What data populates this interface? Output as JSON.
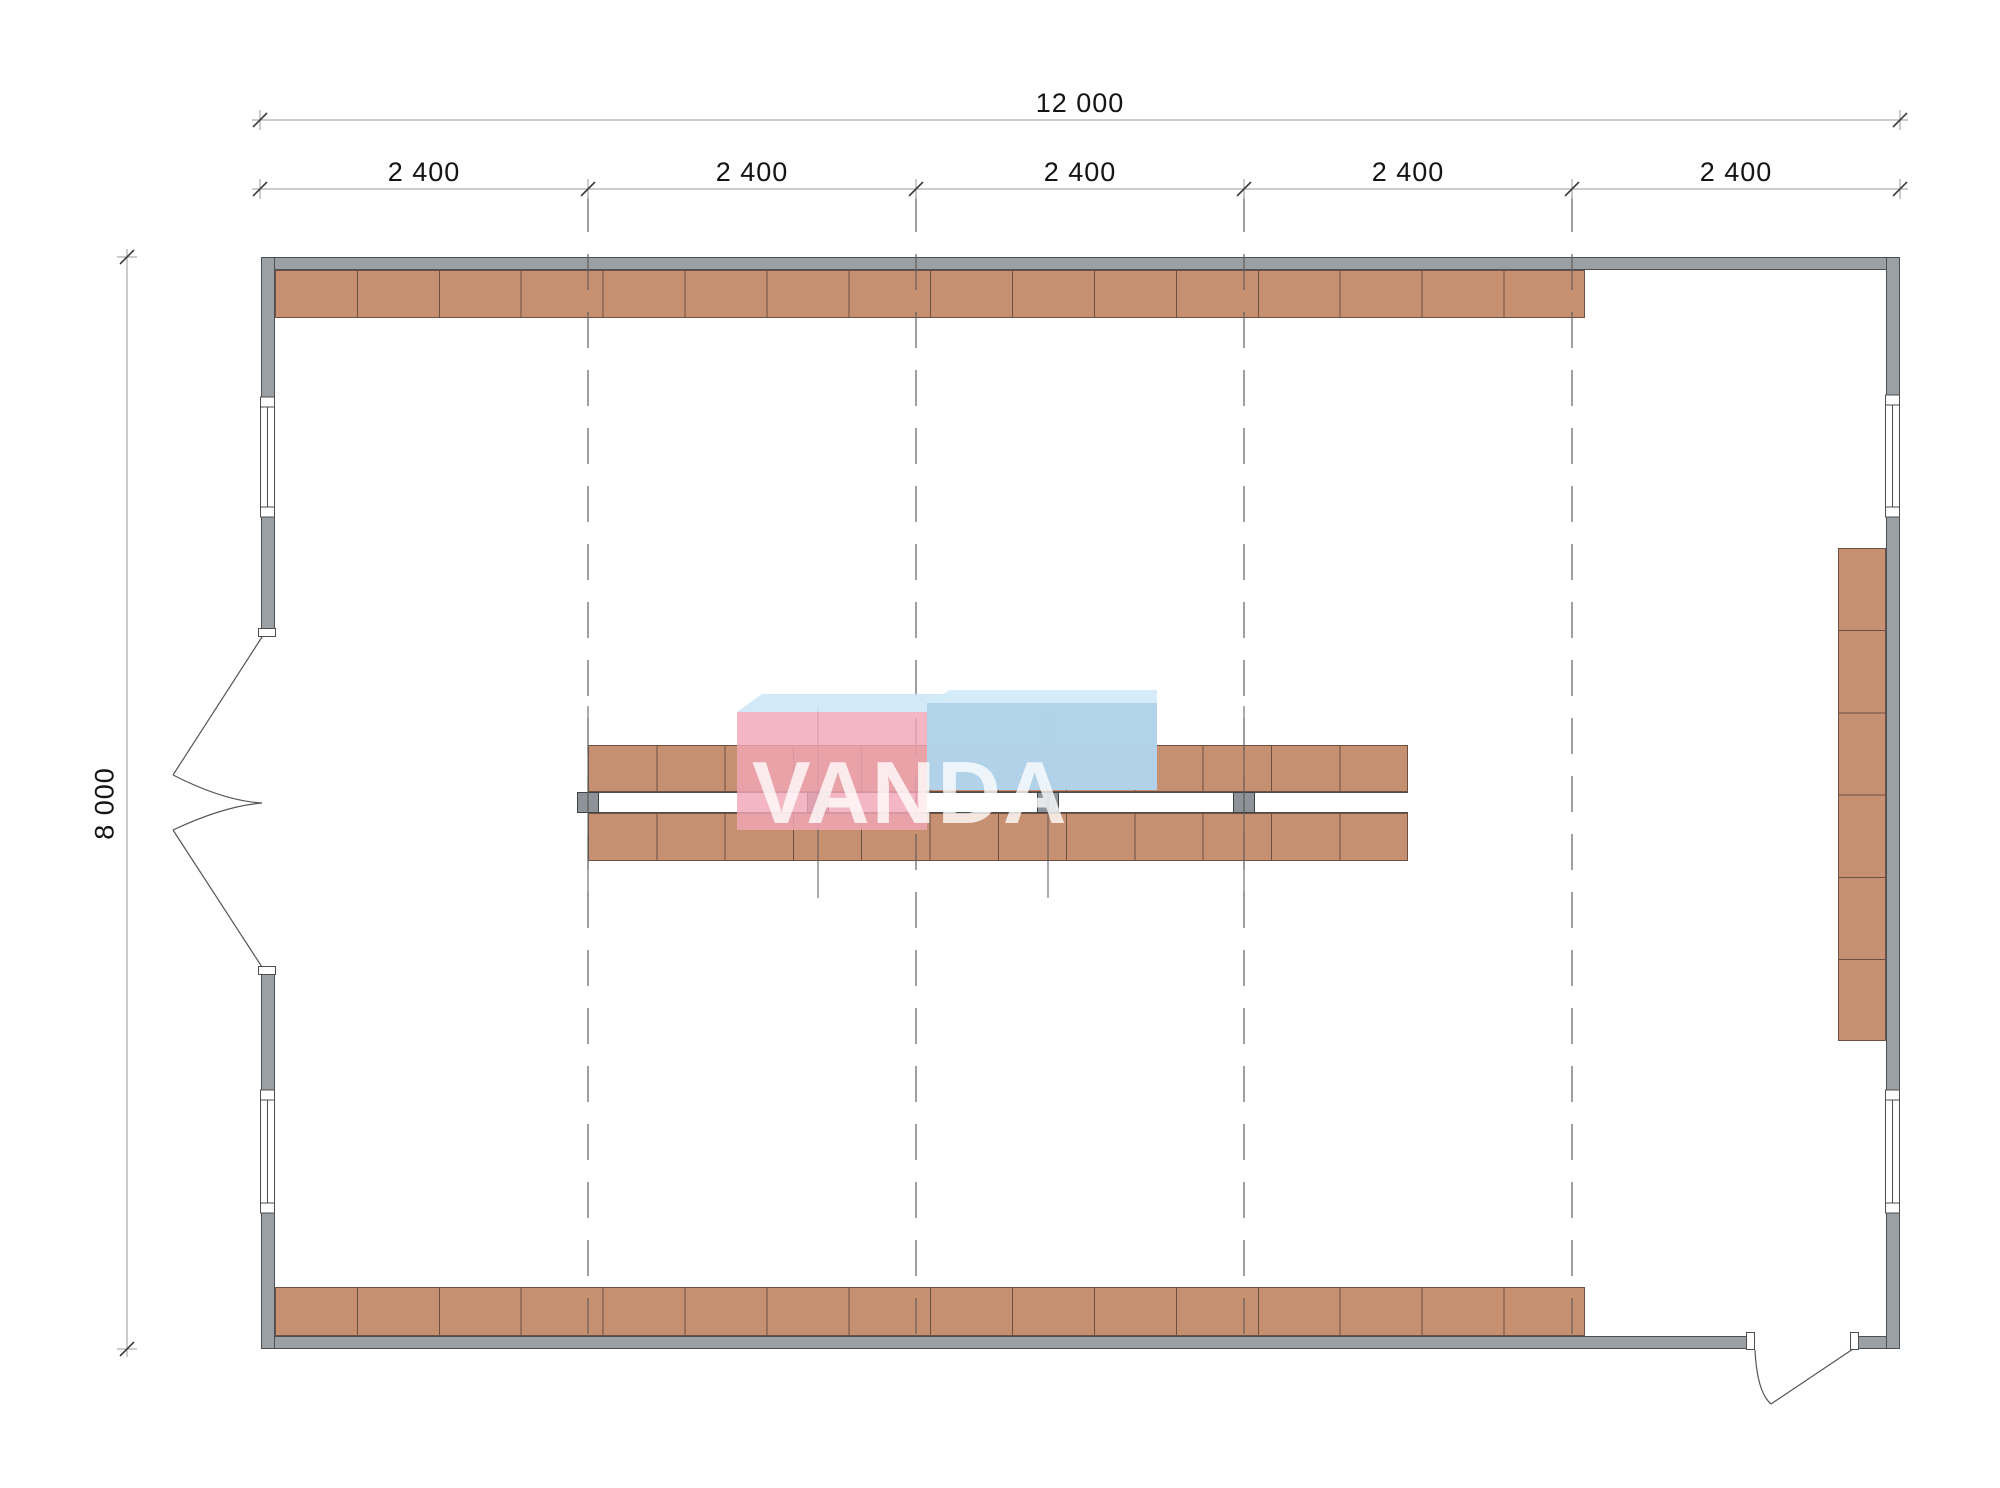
{
  "drawing": {
    "kind": "warehouse-hall floor plan",
    "units_note": "millimetres"
  },
  "dimensions": {
    "overall_width": "12 000",
    "overall_depth": "8 000",
    "bays": [
      "2 400",
      "2 400",
      "2 400",
      "2 400",
      "2 400"
    ]
  },
  "watermark": {
    "text": "VANDA",
    "pink_cube_color": "#f2a6b6",
    "blue_cube_color": "#a8cde7",
    "cube_top_color": "#cde8f6"
  },
  "shelving": {
    "top_wall_row_sections": 16,
    "bottom_wall_row_sections": 16,
    "right_wall_column_sections": 6,
    "center_rack_upper_sections": 12,
    "center_rack_lower_sections": 12,
    "center_rack_posts": 4,
    "shelf_color": "#c79070",
    "shelf_border_color": "#6e5043"
  },
  "structure": {
    "wall_color": "#9aa0a4",
    "grid_line_style": "dashed",
    "grid_lines": 4,
    "windows_left_wall": 2,
    "windows_right_wall": 2,
    "double_door_left_wall": 1,
    "single_door_bottom_wall": 1
  }
}
